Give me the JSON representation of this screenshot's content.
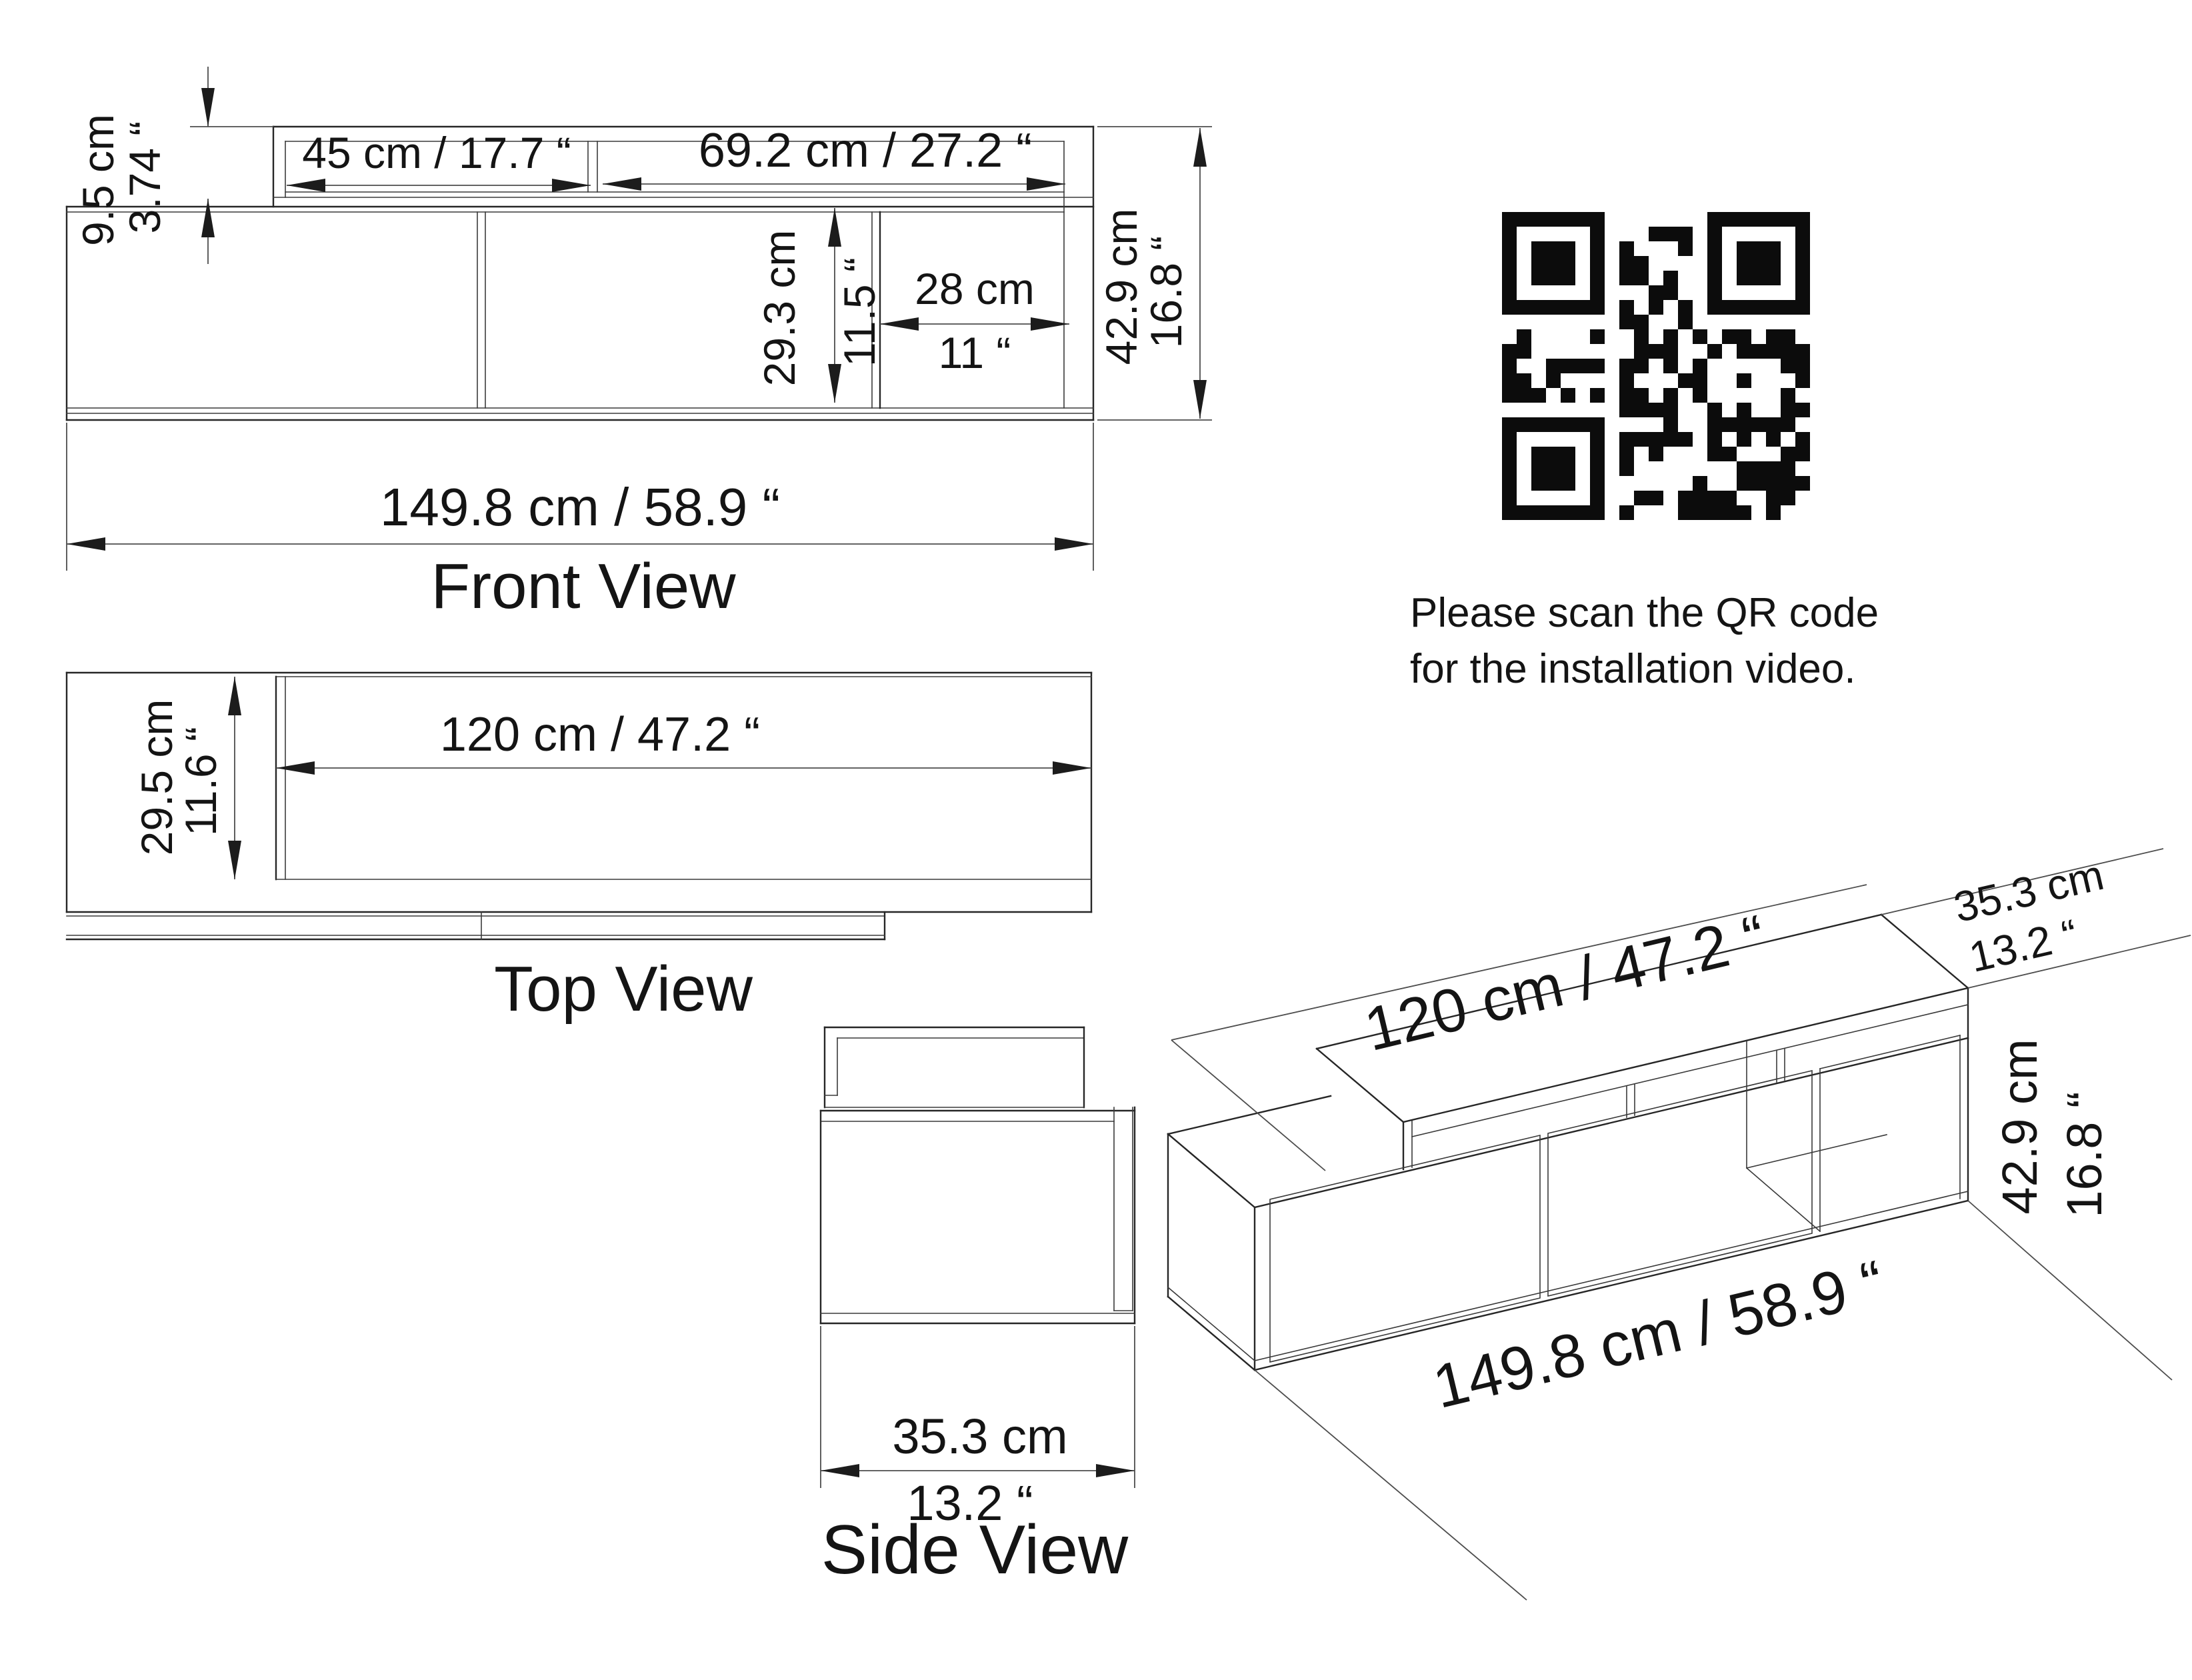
{
  "front_view": {
    "title": "Front View",
    "shelf_height_cm": "9.5 cm",
    "shelf_height_in": "3.74 “",
    "left_shelf_width": "45 cm / 17.7 “",
    "right_shelf_width": "69.2 cm / 27.2 “",
    "niche_height_cm": "29.3 cm",
    "niche_height_in": "11.5 “",
    "niche_width_cm": "28 cm",
    "niche_width_in": "11 “",
    "total_height_cm": "42.9 cm",
    "total_height_in": "16.8 “",
    "total_width": "149.8 cm / 58.9 “"
  },
  "top_view": {
    "title": "Top View",
    "depth_cm": "29.5 cm",
    "depth_in": "11.6 “",
    "shelf_width": "120 cm / 47.2 “"
  },
  "side_view": {
    "title": "Side View",
    "depth_cm": "35.3 cm",
    "depth_in": "13.2 “"
  },
  "iso_view": {
    "shelf_width": "120 cm / 47.2 “",
    "depth_cm": "35.3 cm",
    "depth_in": "13.2 “",
    "height_cm": "42.9 cm",
    "height_in": "16.8 “",
    "total_width": "149.8 cm / 58.9 “"
  },
  "qr": {
    "caption_line1": "Please scan the QR code",
    "caption_line2": "for the installation video."
  },
  "colors": {
    "line": "#262626",
    "dim_line": "#4d4d4d",
    "text": "#141414",
    "background": "#ffffff"
  }
}
